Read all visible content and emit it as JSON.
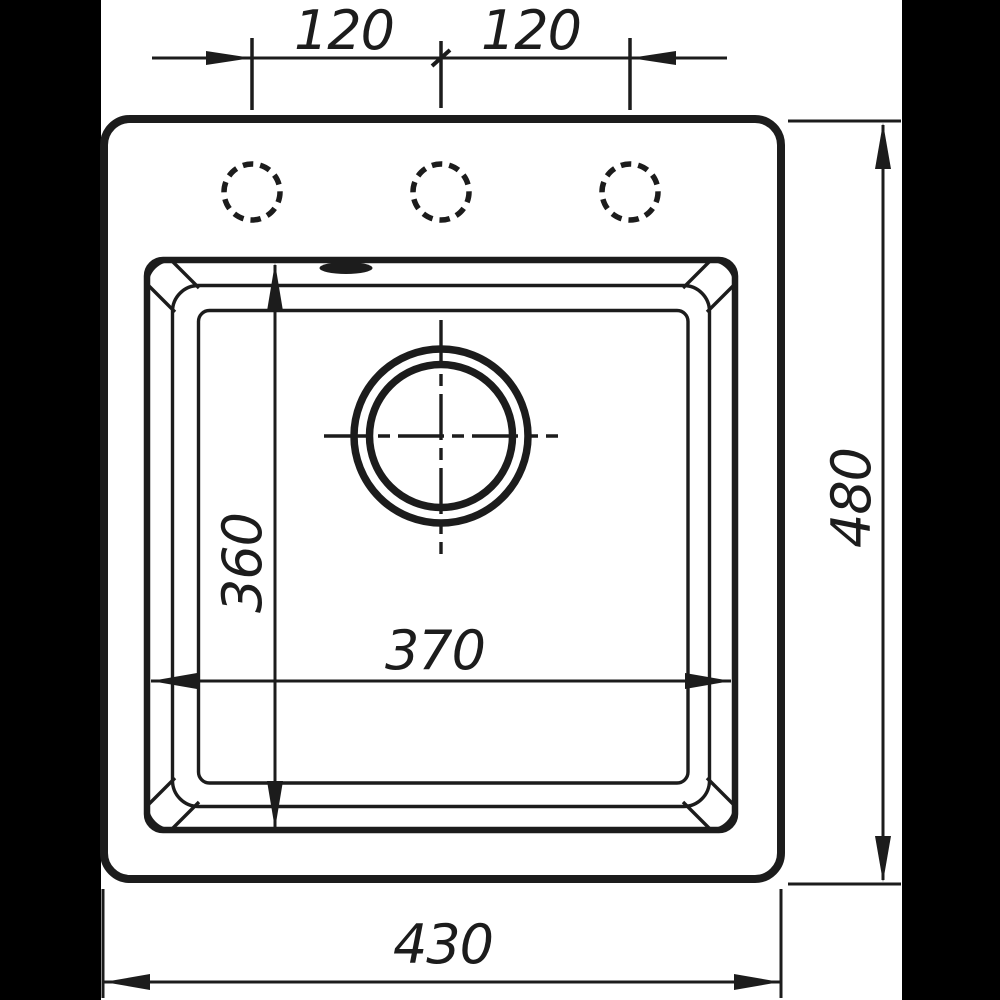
{
  "drawing": {
    "title": "Sink top-view technical drawing",
    "colors": {
      "ink": "#1c1c1c",
      "paper": "#ffffff",
      "letterbox": "#000000"
    },
    "dimensions": {
      "faucet_hole_pitch_left": "120",
      "faucet_hole_pitch_right": "120",
      "overall_depth": "480",
      "bowl_depth": "360",
      "bowl_width": "370",
      "overall_width": "430"
    }
  }
}
